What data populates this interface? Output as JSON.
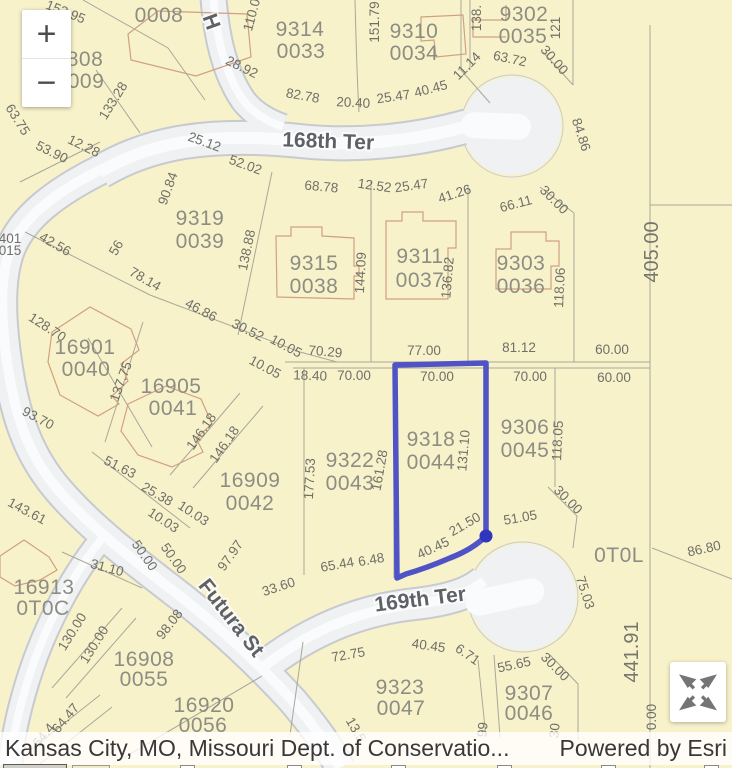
{
  "attribution": {
    "sources": "Kansas City, MO, Missouri Dept. of Conservatio...",
    "powered_by": "Powered by Esri"
  },
  "controls": {
    "zoom_in": "+",
    "zoom_out": "−",
    "expand": "expand-arrows"
  },
  "selection": {
    "parcel_id": "9318 0044",
    "outline_color": "#4f53c5",
    "vertex_color": "#3135bb"
  },
  "colors": {
    "parcel_fill": "#f8f2cb",
    "street_fill": "#eff1f3",
    "street_casing": "#c7cacf",
    "street_center": "#fafbfc",
    "parcel_line": "#a8a89a",
    "building_line": "#cfa182"
  },
  "map": {
    "labels": [
      {
        "t": "0008",
        "x": 159,
        "y": 22,
        "r": 0,
        "c": "p"
      },
      {
        "t": "153.95",
        "x": 64,
        "y": 16,
        "r": 22,
        "c": "d"
      },
      {
        "t": "808",
        "x": 85,
        "y": 66,
        "r": 0,
        "c": "p"
      },
      {
        "t": "009",
        "x": 86,
        "y": 88,
        "r": 0,
        "c": "p"
      },
      {
        "t": "H",
        "x": 205,
        "y": 24,
        "r": 70,
        "c": "s"
      },
      {
        "t": "110.0",
        "x": 256,
        "y": 16,
        "r": -75,
        "c": "d"
      },
      {
        "t": "9314",
        "x": 300,
        "y": 36,
        "r": 0,
        "c": "p"
      },
      {
        "t": "0033",
        "x": 301,
        "y": 58,
        "r": 0,
        "c": "p"
      },
      {
        "t": "151.79",
        "x": 379,
        "y": 22,
        "r": -90,
        "c": "d"
      },
      {
        "t": "9310",
        "x": 414,
        "y": 38,
        "r": 0,
        "c": "p"
      },
      {
        "t": "0034",
        "x": 414,
        "y": 60,
        "r": 0,
        "c": "p"
      },
      {
        "t": "138.",
        "x": 481,
        "y": 18,
        "r": -90,
        "c": "d"
      },
      {
        "t": "121",
        "x": 560,
        "y": 28,
        "r": -90,
        "c": "d"
      },
      {
        "t": "9302",
        "x": 524,
        "y": 21,
        "r": 0,
        "c": "p"
      },
      {
        "t": "0035",
        "x": 523,
        "y": 43,
        "r": 0,
        "c": "p"
      },
      {
        "t": "63.75",
        "x": 14,
        "y": 122,
        "r": 58,
        "c": "d"
      },
      {
        "t": "53.90",
        "x": 50,
        "y": 156,
        "r": 26,
        "c": "d"
      },
      {
        "t": "12.28",
        "x": 82,
        "y": 150,
        "r": 26,
        "c": "d"
      },
      {
        "t": "133.28",
        "x": 117,
        "y": 103,
        "r": -58,
        "c": "d"
      },
      {
        "t": "28.92",
        "x": 240,
        "y": 71,
        "r": 26,
        "c": "d"
      },
      {
        "t": "82.78",
        "x": 302,
        "y": 100,
        "r": 10,
        "c": "d"
      },
      {
        "t": "20.40",
        "x": 353,
        "y": 107,
        "r": 3,
        "c": "d"
      },
      {
        "t": "25.47",
        "x": 394,
        "y": 101,
        "r": -8,
        "c": "d"
      },
      {
        "t": "40.45",
        "x": 432,
        "y": 93,
        "r": -15,
        "c": "d"
      },
      {
        "t": "11.14",
        "x": 470,
        "y": 69,
        "r": -45,
        "c": "d"
      },
      {
        "t": "63.72",
        "x": 509,
        "y": 63,
        "r": 12,
        "c": "d"
      },
      {
        "t": "30.00",
        "x": 551,
        "y": 63,
        "r": 48,
        "c": "d"
      },
      {
        "t": "84.86",
        "x": 577,
        "y": 136,
        "r": 72,
        "c": "d"
      },
      {
        "t": "168th Ter",
        "x": 328,
        "y": 148,
        "r": 2,
        "c": "s"
      },
      {
        "t": "25.12",
        "x": 203,
        "y": 146,
        "r": 20,
        "c": "d"
      },
      {
        "t": "52.02",
        "x": 244,
        "y": 169,
        "r": 20,
        "c": "d"
      },
      {
        "t": "68.78",
        "x": 321,
        "y": 191,
        "r": 5,
        "c": "d"
      },
      {
        "t": "12.52",
        "x": 374,
        "y": 190,
        "r": 8,
        "c": "d"
      },
      {
        "t": "25.47",
        "x": 412,
        "y": 190,
        "r": -8,
        "c": "d"
      },
      {
        "t": "41.26",
        "x": 456,
        "y": 198,
        "r": -18,
        "c": "d"
      },
      {
        "t": "66.11",
        "x": 517,
        "y": 208,
        "r": -15,
        "c": "d"
      },
      {
        "t": "30.00",
        "x": 551,
        "y": 203,
        "r": 45,
        "c": "d"
      },
      {
        "t": "405.00",
        "x": 658,
        "y": 252,
        "r": -90,
        "c": "D"
      },
      {
        "t": "90.84",
        "x": 172,
        "y": 190,
        "r": -70,
        "c": "d"
      },
      {
        "t": "9319",
        "x": 200,
        "y": 225,
        "r": 0,
        "c": "p"
      },
      {
        "t": "0039",
        "x": 200,
        "y": 248,
        "r": 0,
        "c": "p"
      },
      {
        "t": "42.56",
        "x": 53,
        "y": 248,
        "r": 30,
        "c": "d"
      },
      {
        "t": "78.14",
        "x": 143,
        "y": 283,
        "r": 30,
        "c": "d"
      },
      {
        "t": "46.86",
        "x": 199,
        "y": 314,
        "r": 28,
        "c": "d"
      },
      {
        "t": "30.52",
        "x": 246,
        "y": 334,
        "r": 26,
        "c": "d"
      },
      {
        "t": "10.05",
        "x": 284,
        "y": 350,
        "r": 28,
        "c": "d"
      },
      {
        "t": "70.29",
        "x": 325,
        "y": 356,
        "r": 5,
        "c": "d"
      },
      {
        "t": "10.05",
        "x": 263,
        "y": 371,
        "r": 28,
        "c": "d"
      },
      {
        "t": "18.40",
        "x": 310,
        "y": 380,
        "r": 2,
        "c": "d"
      },
      {
        "t": "70.00",
        "x": 354,
        "y": 380,
        "r": 0,
        "c": "d"
      },
      {
        "t": "77.00",
        "x": 424,
        "y": 355,
        "r": 0,
        "c": "d"
      },
      {
        "t": "81.12",
        "x": 519,
        "y": 352,
        "r": 0,
        "c": "d"
      },
      {
        "t": "60.00",
        "x": 612,
        "y": 354,
        "r": 0,
        "c": "d"
      },
      {
        "t": "70.00",
        "x": 437,
        "y": 381,
        "r": 0,
        "c": "d"
      },
      {
        "t": "70.00",
        "x": 530,
        "y": 381,
        "r": 0,
        "c": "d"
      },
      {
        "t": "60.00",
        "x": 614,
        "y": 382,
        "r": 0,
        "c": "d"
      },
      {
        "t": "138.88",
        "x": 251,
        "y": 251,
        "r": -78,
        "c": "d"
      },
      {
        "t": "9315",
        "x": 314,
        "y": 270,
        "r": 0,
        "c": "p"
      },
      {
        "t": "0038",
        "x": 314,
        "y": 293,
        "r": 0,
        "c": "p"
      },
      {
        "t": "144.09",
        "x": 365,
        "y": 273,
        "r": -87,
        "c": "d"
      },
      {
        "t": "9311",
        "x": 420,
        "y": 263,
        "r": 0,
        "c": "p"
      },
      {
        "t": "0037",
        "x": 420,
        "y": 287,
        "r": 0,
        "c": "p"
      },
      {
        "t": "136.82",
        "x": 452,
        "y": 278,
        "r": -85,
        "c": "d"
      },
      {
        "t": "9303",
        "x": 521,
        "y": 270,
        "r": 0,
        "c": "p"
      },
      {
        "t": "0036",
        "x": 521,
        "y": 293,
        "r": 0,
        "c": "p"
      },
      {
        "t": "118.06",
        "x": 564,
        "y": 288,
        "r": -87,
        "c": "d"
      },
      {
        "t": "128.70",
        "x": 45,
        "y": 331,
        "r": 33,
        "c": "d"
      },
      {
        "t": "16901",
        "x": 85,
        "y": 354,
        "r": 0,
        "c": "p"
      },
      {
        "t": "0040",
        "x": 86,
        "y": 376,
        "r": 0,
        "c": "p"
      },
      {
        "t": "137.75",
        "x": 125,
        "y": 383,
        "r": -70,
        "c": "d"
      },
      {
        "t": "93.70",
        "x": 36,
        "y": 422,
        "r": 28,
        "c": "d"
      },
      {
        "t": "16905",
        "x": 171,
        "y": 393,
        "r": 0,
        "c": "p"
      },
      {
        "t": "0041",
        "x": 173,
        "y": 415,
        "r": 0,
        "c": "p"
      },
      {
        "t": "146.18",
        "x": 205,
        "y": 434,
        "r": -55,
        "c": "d"
      },
      {
        "t": "146.18",
        "x": 228,
        "y": 447,
        "r": -55,
        "c": "d"
      },
      {
        "t": "51.63",
        "x": 118,
        "y": 471,
        "r": 27,
        "c": "d"
      },
      {
        "t": "25.38",
        "x": 155,
        "y": 498,
        "r": 30,
        "c": "d"
      },
      {
        "t": "143.61",
        "x": 25,
        "y": 515,
        "r": 28,
        "c": "d"
      },
      {
        "t": "16909",
        "x": 250,
        "y": 487,
        "r": 0,
        "c": "p"
      },
      {
        "t": "0042",
        "x": 250,
        "y": 510,
        "r": 0,
        "c": "p"
      },
      {
        "t": "177.53",
        "x": 314,
        "y": 479,
        "r": -87,
        "c": "d"
      },
      {
        "t": "9322",
        "x": 350,
        "y": 467,
        "r": 0,
        "c": "p"
      },
      {
        "t": "0043",
        "x": 350,
        "y": 490,
        "r": 0,
        "c": "p"
      },
      {
        "t": "161.28",
        "x": 384,
        "y": 471,
        "r": -80,
        "c": "d"
      },
      {
        "t": "9318",
        "x": 431,
        "y": 446,
        "r": 0,
        "c": "p"
      },
      {
        "t": "0044",
        "x": 431,
        "y": 469,
        "r": 0,
        "c": "p"
      },
      {
        "t": "131.10",
        "x": 468,
        "y": 451,
        "r": -85,
        "c": "d"
      },
      {
        "t": "9306",
        "x": 525,
        "y": 434,
        "r": 0,
        "c": "p"
      },
      {
        "t": "0045",
        "x": 525,
        "y": 457,
        "r": 0,
        "c": "p"
      },
      {
        "t": "118.05",
        "x": 562,
        "y": 441,
        "r": -87,
        "c": "d"
      },
      {
        "t": "10.03",
        "x": 161,
        "y": 524,
        "r": 33,
        "c": "d"
      },
      {
        "t": "10.03",
        "x": 191,
        "y": 517,
        "r": 33,
        "c": "d"
      },
      {
        "t": "50.00",
        "x": 141,
        "y": 558,
        "r": 55,
        "c": "d"
      },
      {
        "t": "50.00",
        "x": 170,
        "y": 561,
        "r": 55,
        "c": "d"
      },
      {
        "t": "31.10",
        "x": 106,
        "y": 572,
        "r": 15,
        "c": "d"
      },
      {
        "t": "16913",
        "x": 44,
        "y": 594,
        "r": 0,
        "c": "p"
      },
      {
        "t": "0T0C",
        "x": 43,
        "y": 615,
        "r": 0,
        "c": "p"
      },
      {
        "t": "130.00",
        "x": 76,
        "y": 634,
        "r": -58,
        "c": "d"
      },
      {
        "t": "130.00",
        "x": 98,
        "y": 647,
        "r": -58,
        "c": "d"
      },
      {
        "t": "97.97",
        "x": 234,
        "y": 558,
        "r": -55,
        "c": "d"
      },
      {
        "t": "98.08",
        "x": 173,
        "y": 627,
        "r": -52,
        "c": "d"
      },
      {
        "t": "Futura St",
        "x": 226,
        "y": 622,
        "r": 52,
        "c": "s"
      },
      {
        "t": "33.60",
        "x": 280,
        "y": 591,
        "r": -18,
        "c": "d"
      },
      {
        "t": "65.44",
        "x": 338,
        "y": 569,
        "r": -10,
        "c": "d"
      },
      {
        "t": "6.48",
        "x": 372,
        "y": 564,
        "r": -10,
        "c": "d"
      },
      {
        "t": "40.45",
        "x": 435,
        "y": 552,
        "r": -25,
        "c": "d"
      },
      {
        "t": "21.50",
        "x": 467,
        "y": 528,
        "r": -30,
        "c": "d"
      },
      {
        "t": "51.05",
        "x": 521,
        "y": 522,
        "r": -10,
        "c": "d"
      },
      {
        "t": "30.00",
        "x": 565,
        "y": 503,
        "r": 45,
        "c": "d"
      },
      {
        "t": "169th Ter",
        "x": 421,
        "y": 606,
        "r": -7,
        "c": "s"
      },
      {
        "t": "16908",
        "x": 144,
        "y": 666,
        "r": 0,
        "c": "p"
      },
      {
        "t": "0055",
        "x": 144,
        "y": 686,
        "r": 0,
        "c": "p"
      },
      {
        "t": "64.47",
        "x": 69,
        "y": 721,
        "r": -50,
        "c": "d"
      },
      {
        "t": "64.4",
        "x": 47,
        "y": 738,
        "r": -50,
        "c": "d"
      },
      {
        "t": "16920",
        "x": 204,
        "y": 712,
        "r": 0,
        "c": "p"
      },
      {
        "t": "0056",
        "x": 203,
        "y": 732,
        "r": 0,
        "c": "p"
      },
      {
        "t": "72.75",
        "x": 349,
        "y": 659,
        "r": -10,
        "c": "d"
      },
      {
        "t": "40.45",
        "x": 428,
        "y": 650,
        "r": 8,
        "c": "d"
      },
      {
        "t": "6.71",
        "x": 465,
        "y": 658,
        "r": 35,
        "c": "d"
      },
      {
        "t": "9323",
        "x": 400,
        "y": 694,
        "r": 0,
        "c": "p"
      },
      {
        "t": "0047",
        "x": 401,
        "y": 715,
        "r": 0,
        "c": "p"
      },
      {
        "t": "13.5",
        "x": 352,
        "y": 732,
        "r": 60,
        "c": "d"
      },
      {
        "t": "55.65",
        "x": 515,
        "y": 669,
        "r": -12,
        "c": "d"
      },
      {
        "t": "30.00",
        "x": 552,
        "y": 670,
        "r": 45,
        "c": "d"
      },
      {
        "t": "9307",
        "x": 529,
        "y": 700,
        "r": 0,
        "c": "p"
      },
      {
        "t": "0046",
        "x": 529,
        "y": 720,
        "r": 0,
        "c": "p"
      },
      {
        "t": "99",
        "x": 487,
        "y": 730,
        "r": -85,
        "c": "d"
      },
      {
        "t": "30",
        "x": 559,
        "y": 731,
        "r": -85,
        "c": "d"
      },
      {
        "t": "0T0L",
        "x": 619,
        "y": 562,
        "r": 0,
        "c": "p"
      },
      {
        "t": "86.80",
        "x": 705,
        "y": 553,
        "r": -12,
        "c": "d"
      },
      {
        "t": "75.03",
        "x": 581,
        "y": 594,
        "r": 72,
        "c": "d"
      },
      {
        "t": "441.91",
        "x": 638,
        "y": 652,
        "r": -90,
        "c": "D"
      },
      {
        "t": "0.00",
        "x": 656,
        "y": 717,
        "r": -90,
        "c": "d"
      },
      {
        "t": "401",
        "x": 10,
        "y": 243,
        "r": 0,
        "c": "d"
      },
      {
        "t": "015",
        "x": 10,
        "y": 255,
        "r": 0,
        "c": "d"
      },
      {
        "t": "56",
        "x": 120,
        "y": 250,
        "r": -60,
        "c": "d"
      }
    ]
  }
}
